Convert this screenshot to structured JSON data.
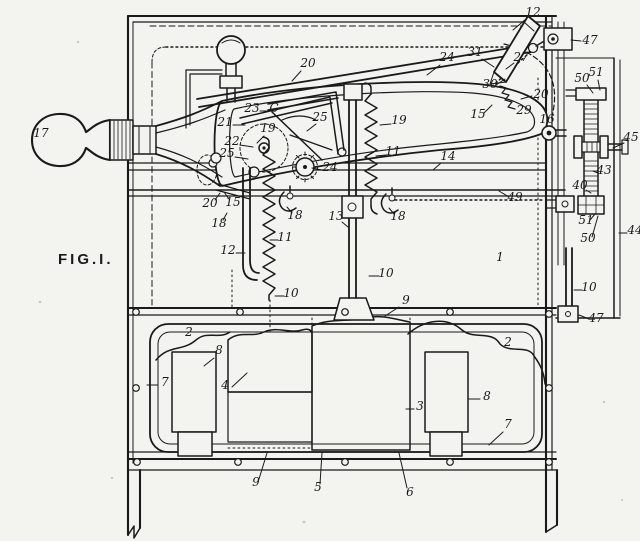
{
  "figure": {
    "label": "FIG.I."
  },
  "colors": {
    "ink": "#1a1a1a",
    "paper": "#f3f3f0"
  },
  "drawing": {
    "type": "patent-line-drawing",
    "part_labels": [
      {
        "text": "12",
        "x": 533,
        "y": 16,
        "leader": [
          526,
          19,
          513,
          30
        ]
      },
      {
        "text": "47",
        "x": 590,
        "y": 44,
        "leader": [
          581,
          41,
          571,
          40
        ]
      },
      {
        "text": "24",
        "x": 447,
        "y": 61,
        "leader": [
          440,
          65,
          427,
          75
        ]
      },
      {
        "text": "31",
        "x": 475,
        "y": 56,
        "leader": [
          482,
          59,
          494,
          67
        ]
      },
      {
        "text": "27",
        "x": 521,
        "y": 61,
        "leader": [
          514,
          63,
          506,
          69
        ]
      },
      {
        "text": "20",
        "x": 308,
        "y": 67,
        "leader": [
          301,
          71,
          292,
          81
        ]
      },
      {
        "text": "30",
        "x": 490,
        "y": 88,
        "leader": [
          496,
          85,
          505,
          79
        ]
      },
      {
        "text": "20",
        "x": 541,
        "y": 98,
        "leader": [
          532,
          96,
          521,
          99
        ]
      },
      {
        "text": "29",
        "x": 524,
        "y": 114
      },
      {
        "text": "15",
        "x": 478,
        "y": 118,
        "leader": [
          484,
          113,
          492,
          105
        ]
      },
      {
        "text": "16",
        "x": 547,
        "y": 123
      },
      {
        "text": "23",
        "x": 252,
        "y": 112,
        "leader": [
          260,
          111,
          269,
          111
        ]
      },
      {
        "text": "C",
        "x": 274,
        "y": 112
      },
      {
        "text": "21",
        "x": 225,
        "y": 126,
        "leader": [
          233,
          125,
          245,
          125
        ]
      },
      {
        "text": "19",
        "x": 268,
        "y": 132,
        "leader": [
          264,
          136,
          257,
          143
        ]
      },
      {
        "text": "22",
        "x": 232,
        "y": 145,
        "leader": [
          240,
          145,
          253,
          147
        ]
      },
      {
        "text": "25",
        "x": 227,
        "y": 157,
        "leader": [
          235,
          157,
          248,
          159
        ]
      },
      {
        "text": "25",
        "x": 320,
        "y": 121,
        "leader": [
          316,
          124,
          307,
          131
        ]
      },
      {
        "text": "24",
        "x": 330,
        "y": 171,
        "leader": [
          322,
          170,
          312,
          168
        ]
      },
      {
        "text": "19",
        "x": 399,
        "y": 124,
        "leader": [
          391,
          124,
          380,
          125
        ]
      },
      {
        "text": "11",
        "x": 393,
        "y": 155,
        "leader": [
          386,
          155,
          376,
          156
        ]
      },
      {
        "text": "14",
        "x": 448,
        "y": 160,
        "leader": [
          441,
          163,
          433,
          170
        ]
      },
      {
        "text": "13",
        "x": 336,
        "y": 220,
        "leader": [
          342,
          222,
          348,
          227
        ]
      },
      {
        "text": "18",
        "x": 295,
        "y": 219,
        "leader": [
          292,
          213,
          287,
          207
        ]
      },
      {
        "text": "18",
        "x": 398,
        "y": 220,
        "leader": [
          394,
          214,
          389,
          208
        ]
      },
      {
        "text": "20",
        "x": 210,
        "y": 207,
        "leader": [
          215,
          200,
          220,
          193
        ]
      },
      {
        "text": "15",
        "x": 233,
        "y": 206,
        "leader": [
          229,
          199,
          224,
          192
        ]
      },
      {
        "text": "18",
        "x": 219,
        "y": 227,
        "leader": [
          223,
          220,
          227,
          213
        ]
      },
      {
        "text": "11",
        "x": 285,
        "y": 241,
        "leader": [
          278,
          240,
          270,
          240
        ]
      },
      {
        "text": "12",
        "x": 228,
        "y": 254,
        "leader": [
          236,
          253,
          245,
          253
        ]
      },
      {
        "text": "10",
        "x": 291,
        "y": 297,
        "leader": [
          284,
          296,
          275,
          296
        ]
      },
      {
        "text": "10",
        "x": 386,
        "y": 277,
        "leader": [
          379,
          276,
          369,
          276
        ]
      },
      {
        "text": "49",
        "x": 515,
        "y": 201,
        "leader": [
          509,
          197,
          499,
          191
        ]
      },
      {
        "text": "1",
        "x": 500,
        "y": 261
      },
      {
        "text": "50",
        "x": 582,
        "y": 82,
        "leader": [
          587,
          85,
          593,
          93
        ]
      },
      {
        "text": "51",
        "x": 596,
        "y": 76,
        "leader": [
          598,
          80,
          600,
          90
        ]
      },
      {
        "text": "45",
        "x": 631,
        "y": 141,
        "leader": [
          624,
          143,
          613,
          148
        ]
      },
      {
        "text": "43",
        "x": 604,
        "y": 174,
        "leader": [
          598,
          173,
          593,
          171
        ]
      },
      {
        "text": "40",
        "x": 580,
        "y": 189,
        "leader": [
          586,
          190,
          591,
          193
        ]
      },
      {
        "text": "51",
        "x": 586,
        "y": 224,
        "leader": [
          590,
          220,
          595,
          214
        ]
      },
      {
        "text": "50",
        "x": 588,
        "y": 242,
        "leader": [
          592,
          237,
          598,
          216
        ]
      },
      {
        "text": "44",
        "x": 635,
        "y": 234,
        "leader": [
          627,
          233,
          619,
          233
        ]
      },
      {
        "text": "10",
        "x": 589,
        "y": 291,
        "leader": [
          582,
          290,
          574,
          290
        ]
      },
      {
        "text": "47",
        "x": 596,
        "y": 322,
        "leader": [
          589,
          319,
          579,
          315
        ]
      },
      {
        "text": "2",
        "x": 189,
        "y": 336
      },
      {
        "text": "2",
        "x": 508,
        "y": 346
      },
      {
        "text": "8",
        "x": 219,
        "y": 354,
        "leader": [
          214,
          358,
          204,
          366
        ]
      },
      {
        "text": "7",
        "x": 165,
        "y": 386,
        "leader": [
          158,
          385,
          147,
          385
        ]
      },
      {
        "text": "4",
        "x": 225,
        "y": 389,
        "leader": [
          232,
          387,
          247,
          373
        ]
      },
      {
        "text": "9",
        "x": 406,
        "y": 304,
        "leader": [
          399,
          307,
          385,
          316
        ]
      },
      {
        "text": "3",
        "x": 420,
        "y": 410,
        "leader": [
          414,
          409,
          406,
          409
        ]
      },
      {
        "text": "8",
        "x": 487,
        "y": 400,
        "leader": [
          480,
          399,
          469,
          399
        ]
      },
      {
        "text": "7",
        "x": 508,
        "y": 428,
        "leader": [
          503,
          432,
          489,
          445
        ]
      },
      {
        "text": "9",
        "x": 256,
        "y": 486,
        "leader": [
          259,
          479,
          267,
          453
        ]
      },
      {
        "text": "5",
        "x": 318,
        "y": 491,
        "leader": [
          320,
          484,
          322,
          453
        ]
      },
      {
        "text": "6",
        "x": 410,
        "y": 496,
        "leader": [
          407,
          488,
          399,
          453
        ]
      },
      {
        "text": "17",
        "x": 41,
        "y": 137
      }
    ]
  }
}
